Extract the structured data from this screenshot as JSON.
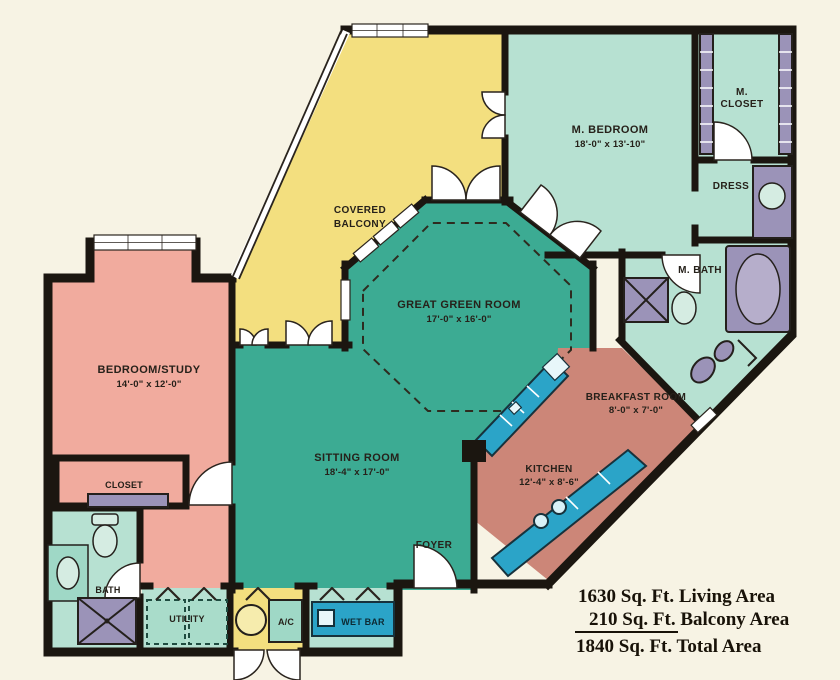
{
  "palette": {
    "bg": "#f7f3e4",
    "wall": "#1b1610",
    "mint": "#b7e1d2",
    "green": "#3cab93",
    "yellow": "#f3df7f",
    "pink": "#f1ab9e",
    "salmon": "#cc8678",
    "cyan": "#2ba4c8",
    "purple": "#9b93b8",
    "ink": "#26211a"
  },
  "rooms": {
    "master_bedroom": {
      "name": "M. BEDROOM",
      "dims": "18'-0\" x 13'-10\""
    },
    "master_closet": {
      "line1": "M.",
      "line2": "CLOSET"
    },
    "dress": {
      "name": "DRESS"
    },
    "master_bath": {
      "name": "M. BATH"
    },
    "great_room": {
      "name": "GREAT GREEN ROOM",
      "dims": "17'-0\" x 16'-0\""
    },
    "covered_balcony": {
      "line1": "COVERED",
      "line2": "BALCONY"
    },
    "sitting_room": {
      "name": "SITTING ROOM",
      "dims": "18'-4\" x 17'-0\""
    },
    "bedroom_study": {
      "name": "BEDROOM/STUDY",
      "dims": "14'-0\" x 12'-0\""
    },
    "breakfast_room": {
      "name": "BREAKFAST ROOM",
      "dims": "8'-0\" x 7'-0\""
    },
    "kitchen": {
      "name": "KITCHEN",
      "dims": "12'-4\" x 8'-6\""
    },
    "foyer": {
      "name": "FOYER"
    },
    "closet": {
      "name": "CLOSET"
    },
    "bath": {
      "name": "BATH"
    },
    "utility": {
      "name": "UTILITY"
    },
    "ac": {
      "name": "A/C"
    },
    "wet_bar": {
      "name": "WET BAR"
    }
  },
  "areas": {
    "living": "1630 Sq. Ft. Living Area",
    "balcony": "210 Sq. Ft. Balcony Area",
    "total": "1840 Sq. Ft. Total Area"
  }
}
